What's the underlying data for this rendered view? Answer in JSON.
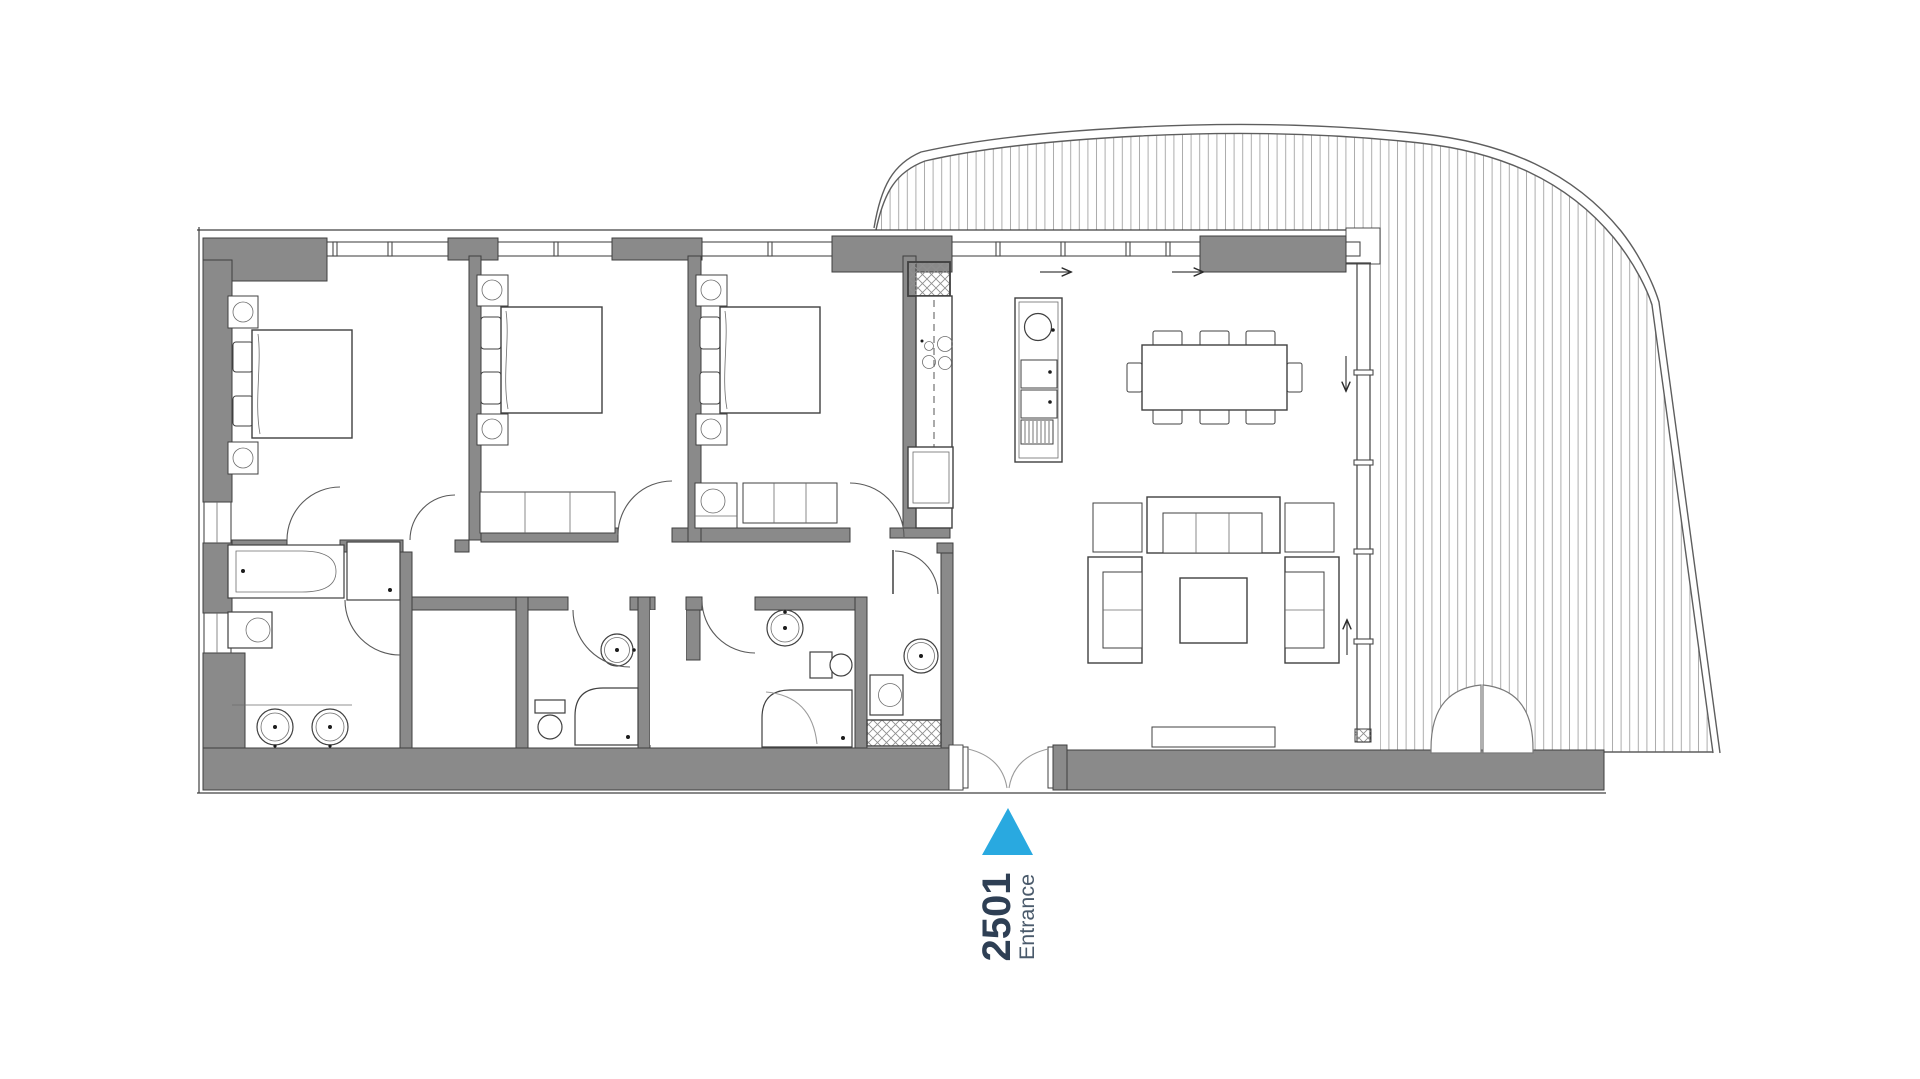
{
  "plan": {
    "unit_number": "2501",
    "entrance_label": "Entrance"
  },
  "icons": {
    "entrance_marker_icon": "triangle-up",
    "flow_arrow_icon": "arrow"
  },
  "colors": {
    "wall_fill": "#8A8A8A",
    "wall_stroke": "#3F3F3F",
    "line_dark": "#404040",
    "door_arc": "#5A5A5A",
    "balcony_line": "#5E5E5E",
    "entrance_marker": "#29A9E0",
    "unit_number_text": "#2E3F54",
    "entrance_text": "#4A5A6B"
  }
}
